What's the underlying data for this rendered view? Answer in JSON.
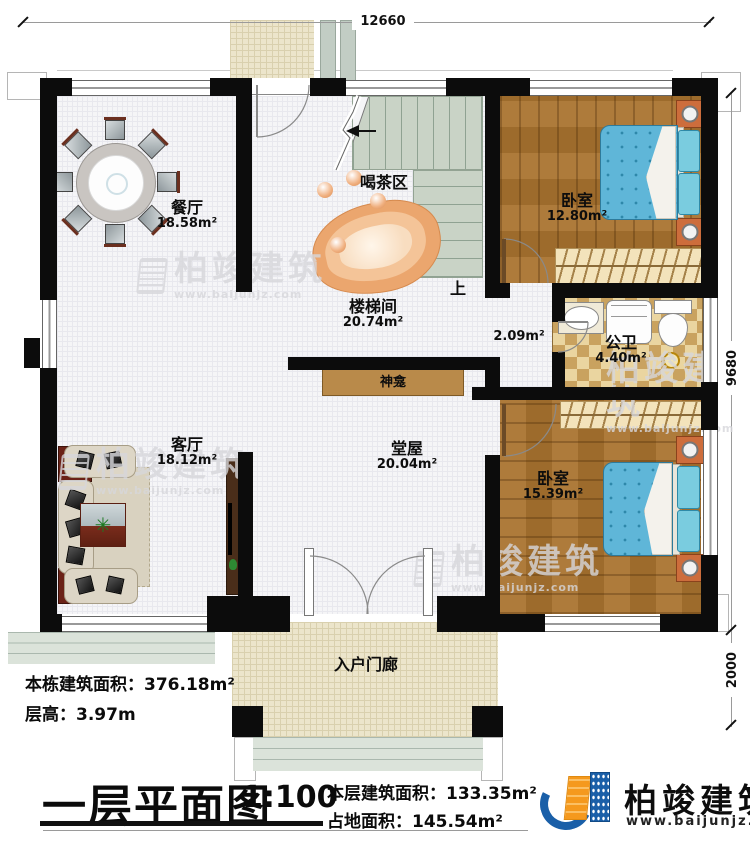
{
  "dimensions": {
    "top": "12660",
    "right": "9680",
    "right_lower": "2000"
  },
  "rooms": {
    "dining": {
      "name": "餐厅",
      "area": "18.58m²"
    },
    "tea": {
      "name": "喝茶区"
    },
    "stairwell": {
      "name": "楼梯间",
      "area": "20.74m²"
    },
    "bedroom1": {
      "name": "卧室",
      "area": "12.80m²"
    },
    "bathroom": {
      "name": "公卫",
      "area": "4.40m²"
    },
    "corridor": {
      "area": "2.09m²"
    },
    "shrine": {
      "name": "神龛"
    },
    "living": {
      "name": "客厅",
      "area": "18.12m²"
    },
    "hall": {
      "name": "堂屋",
      "area": "20.04m²"
    },
    "bedroom2": {
      "name": "卧室",
      "area": "15.39m²"
    },
    "porch": {
      "name": "入户门廊"
    },
    "stairs_up": "上"
  },
  "stats": {
    "building_area_label": "本栋建筑面积：",
    "building_area": "376.18m²",
    "floor_height_label": "层高：",
    "floor_height": "3.97m",
    "floor_area_label": "本层建筑面积：",
    "floor_area": "133.35m²",
    "land_area_label": "占地面积：",
    "land_area": "145.54m²"
  },
  "title": {
    "text": "一层平面图",
    "scale": "1:100"
  },
  "brand": {
    "name": "柏竣建筑",
    "website": "www.baijunjz.com"
  },
  "colors": {
    "brand_blue": "#1a5fa8",
    "brand_orange": "#f5991d",
    "wall_black": "#0c0c0c",
    "wood": "#a9732f",
    "bed_blue": "#5fb6d8"
  }
}
